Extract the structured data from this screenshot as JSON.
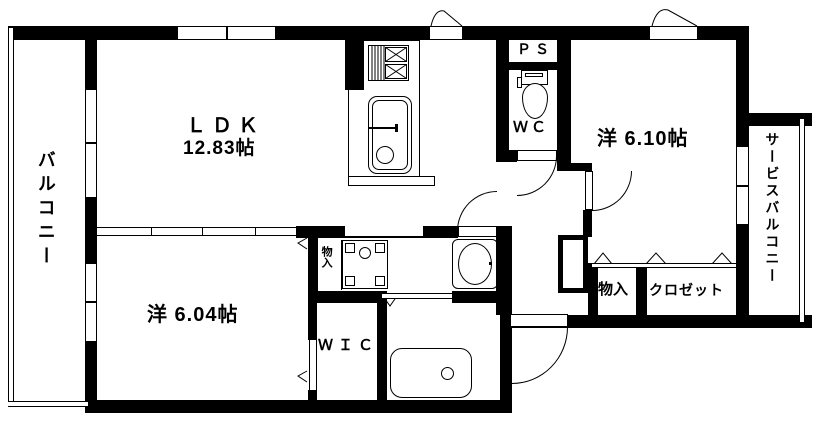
{
  "colors": {
    "line": "#000000",
    "background": "#ffffff"
  },
  "labels": {
    "ldk_name": "ＬＤＫ",
    "ldk_size": "12.83帖",
    "western_room_1": "洋 6.10帖",
    "western_room_2": "洋 6.04帖",
    "balcony": "バルコニー",
    "service_balcony": "サービスバルコニー",
    "wic": "ＷＩＣ",
    "wc": "ＷＣ",
    "ps": "ＰＳ",
    "storage_ldk": "物入",
    "storage_hall": "物入",
    "closet": "クロゼット",
    "shoe_storage": "靴入"
  }
}
